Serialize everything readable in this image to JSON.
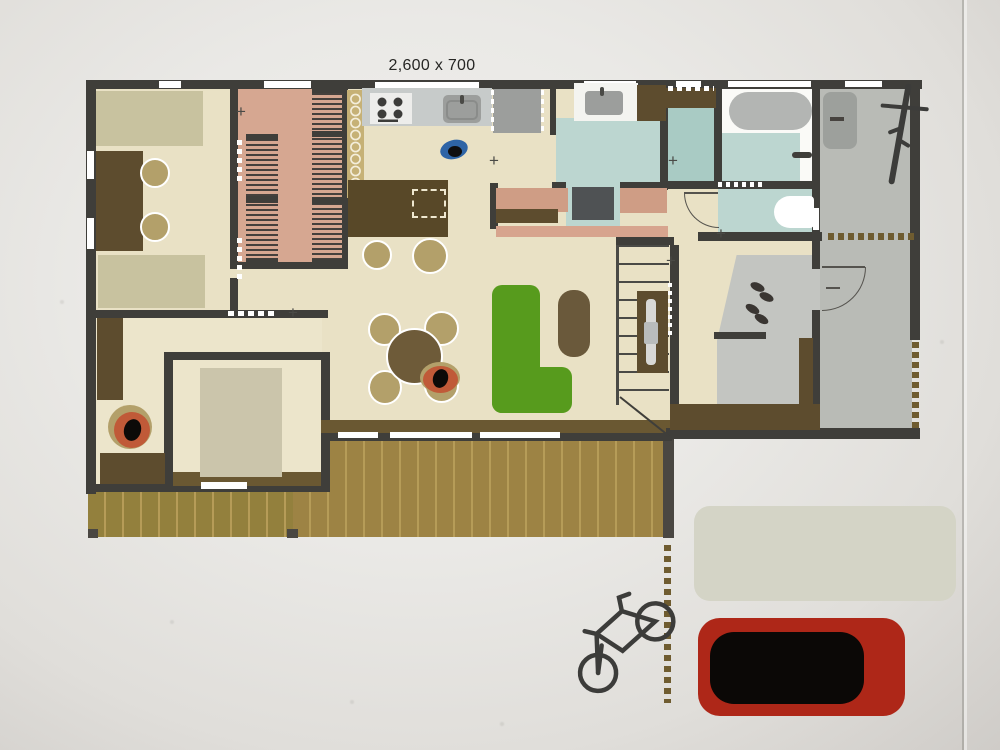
{
  "title_label": {
    "text": "2,600 x 700"
  },
  "palette": {
    "wall": "#3f3e3a",
    "wall_light": "#4a4a46",
    "floor_beige": "#e9e1c5",
    "floor_beige_light": "#ece5cb",
    "closet_pink": "#d6a791",
    "rack_stripe": "#45403c",
    "tile_blue": "#bcd6d0",
    "tile_teal": "#a9cbc4",
    "bath_white": "#fafaf7",
    "tub_gray": "#b3b5b3",
    "carport_gray": "#b9bbb6",
    "genkan_gray": "#c3c5c1",
    "mat_gray": "#9da09c",
    "deck_wood": "#9d8344",
    "deck_wood_left": "#93803d",
    "deck_line": "#b69c58",
    "band_brown": "#6a5832",
    "furniture_brown": "#5d4c2e",
    "island_brown": "#584828",
    "chair_tan": "#b3a06a",
    "rug_green": "#c8c29f",
    "bed_gray": "#cbc5ab",
    "sofa_green": "#579b1d",
    "ottoman_brown": "#6a593b",
    "bench_salmon": "#cf9d85",
    "bench_salmon2": "#d7a48e",
    "counter_gray": "#c7cbca",
    "appliance_gray": "#9c9e9c",
    "stove_white": "#ededeb",
    "robot_blue": "#2e64a6",
    "accent_orange": "#c05a38",
    "car_red": "#ae2718",
    "car_black": "#0b0806",
    "pad_gray": "#d4d4c6",
    "boundary_dash": "#6f5c30",
    "white": "#ffffff",
    "label_ink": "#262624"
  },
  "icons": [
    "bicycle-side-icon",
    "bicycle-top-icon",
    "bathtub-icon",
    "toilet-icon",
    "stove-burners-icon",
    "kitchen-sink-icon",
    "laundry-sink-icon",
    "door-swing-arc-icon",
    "stairs-icon",
    "shoes-icon",
    "robot-vacuum-icon",
    "car-top-view-icon"
  ],
  "legend": {
    "plan_type": "floor-plan-top-view",
    "dimension_note_position": "above-kitchen-window"
  }
}
